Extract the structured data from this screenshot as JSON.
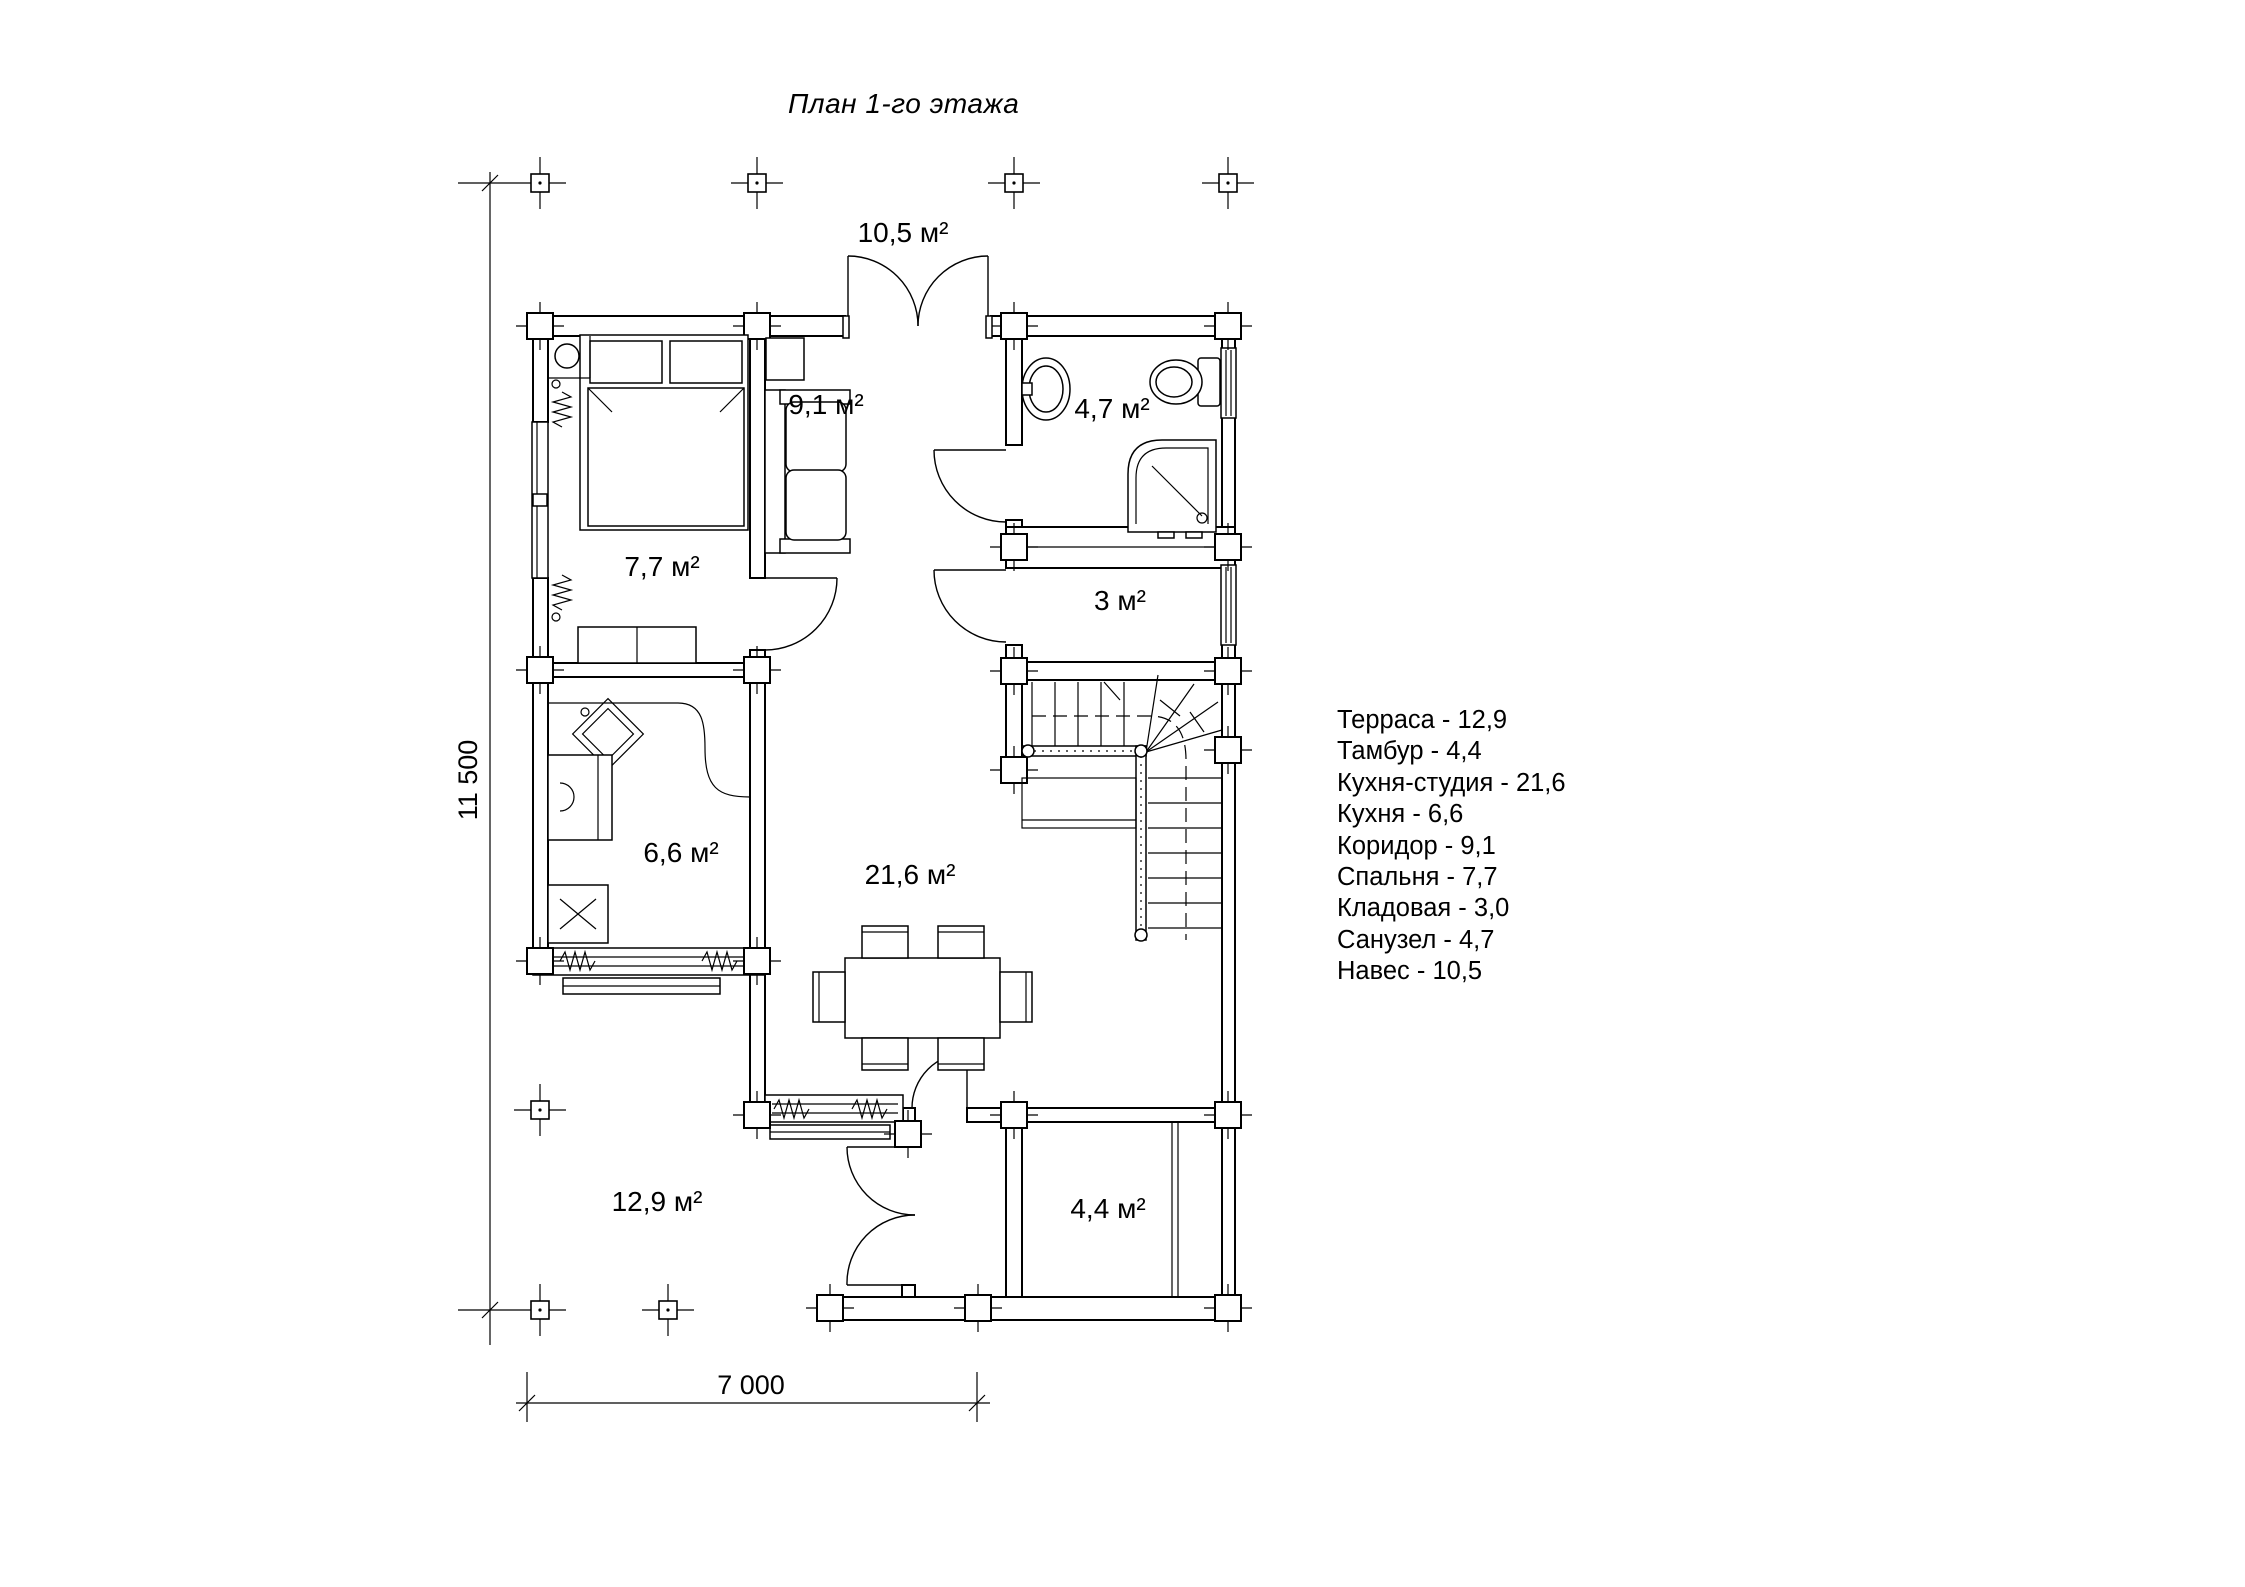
{
  "title": "План 1-го этажа",
  "rooms": {
    "naves": "10,5 м²",
    "koridor": "9,1 м²",
    "sanuzel": "4,7 м²",
    "spalnya": "7,7 м²",
    "kladovaya": "3 м²",
    "kuhnya": "6,6 м²",
    "studio": "21,6 м²",
    "terrasa": "12,9 м²",
    "tambur": "4,4 м²"
  },
  "dimensions": {
    "height": "11 500",
    "width": "7 000"
  },
  "legend": {
    "items": [
      "Терраса - 12,9",
      "Тамбур - 4,4",
      "Кухня-студия - 21,6",
      "Кухня - 6,6",
      "Коридор - 9,1",
      "Спальня - 7,7",
      "Кладовая - 3,0",
      "Санузел - 4,7",
      "Навес - 10,5"
    ]
  }
}
